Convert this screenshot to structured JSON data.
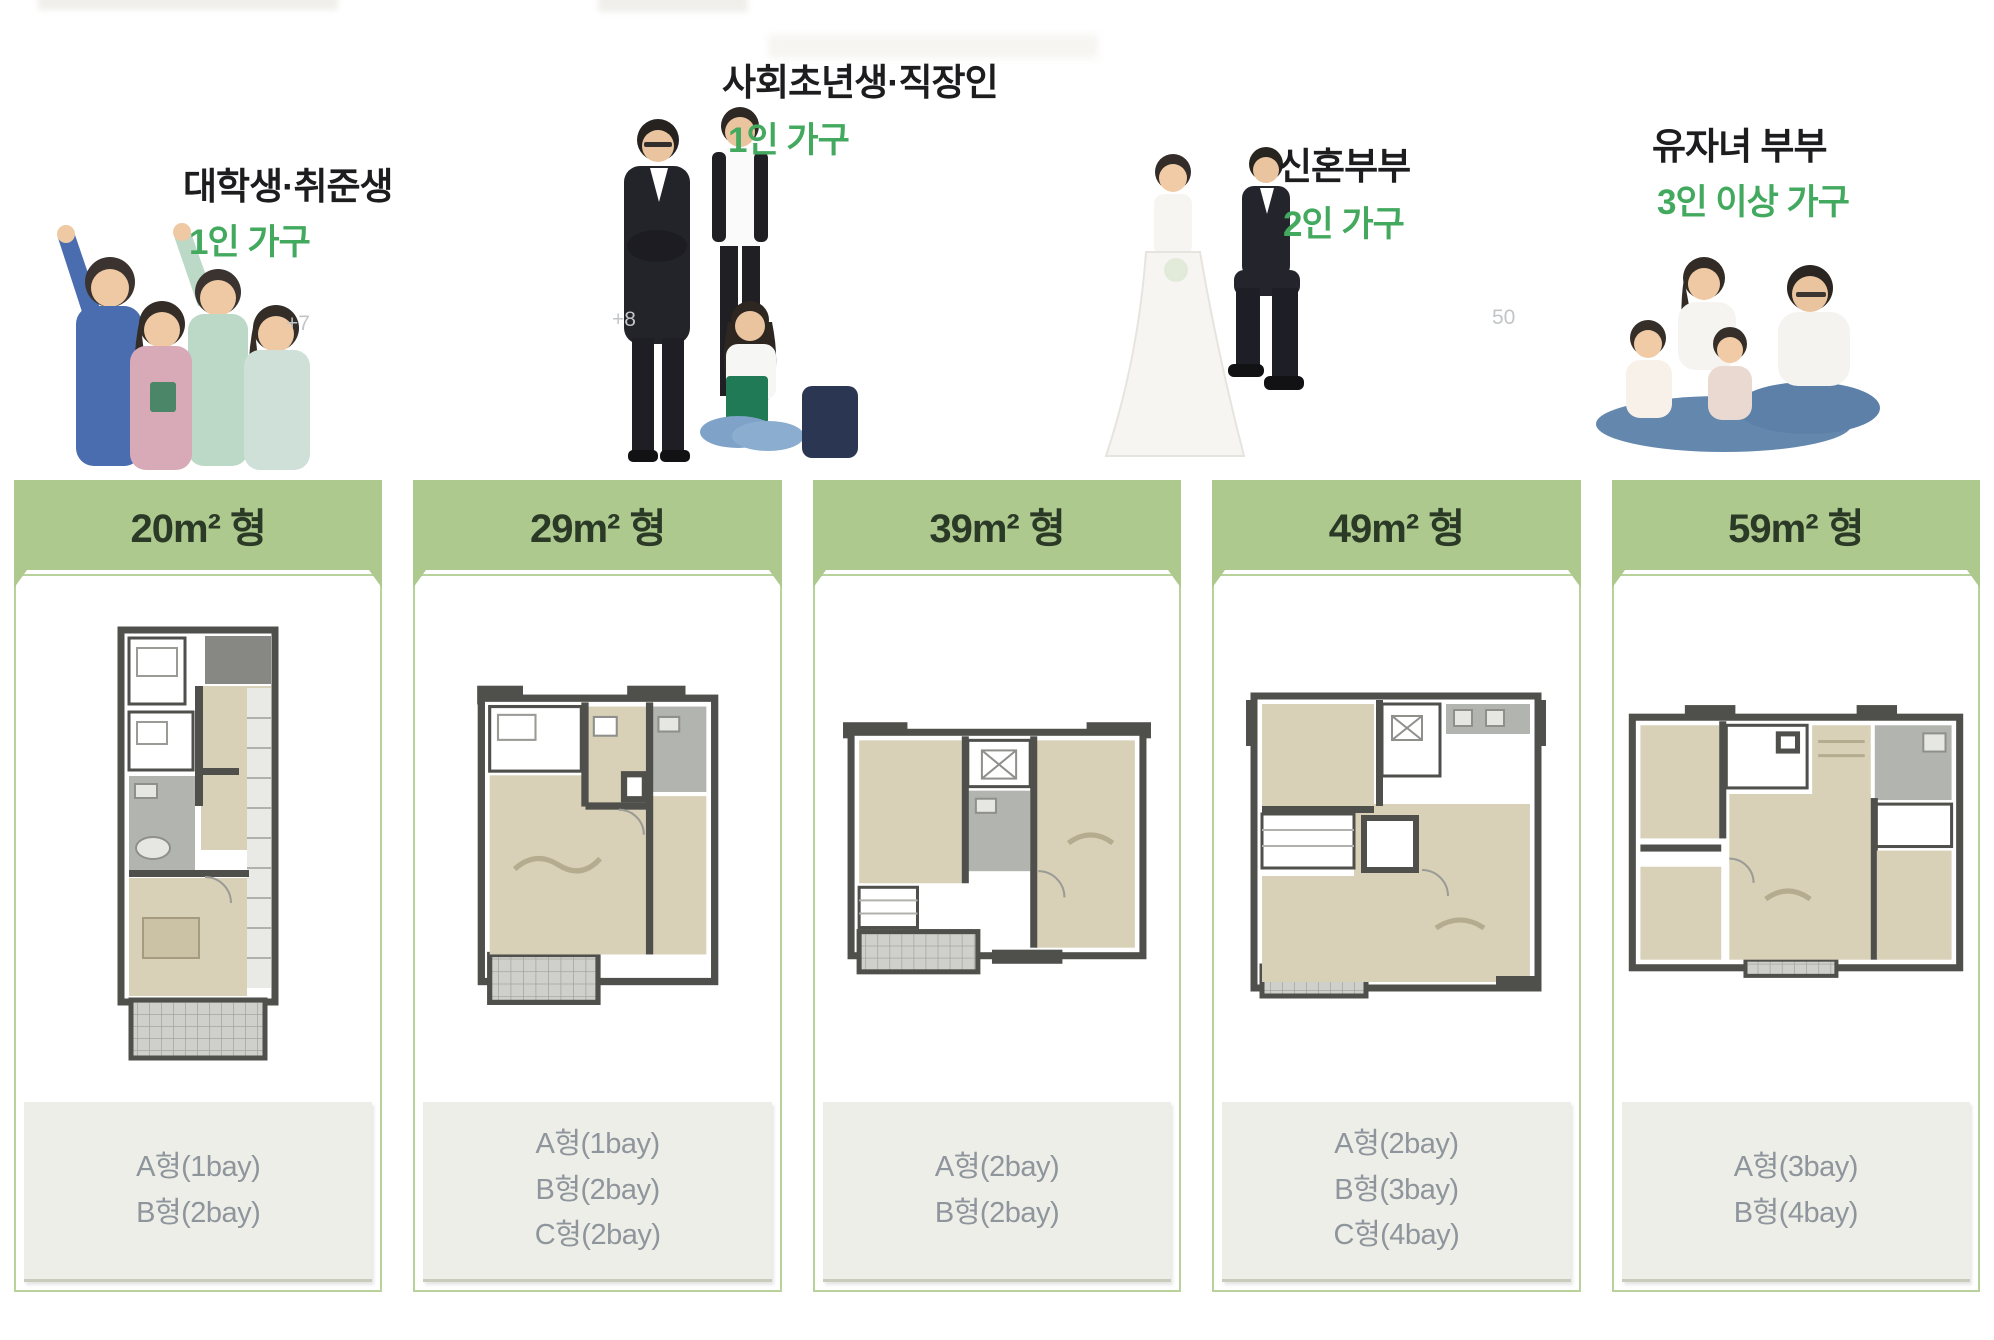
{
  "colors": {
    "accent_green": "#43a95f",
    "bar_green": "#aec98e",
    "bar_text": "#2b3a26",
    "panel_border": "#b9d29b",
    "label_bg": "#edeee7",
    "label_text": "#8f959c"
  },
  "personas": [
    {
      "name": "대학생·취준생",
      "household": "1인 가구",
      "badge": "+7"
    },
    {
      "name": "사회초년생·직장인",
      "household": "1인 가구",
      "badge": "+8"
    },
    {
      "name": "신혼부부",
      "household": "2인 가구",
      "badge": ""
    },
    {
      "name": "유자녀 부부",
      "household": "3인 이상 가구",
      "badge": "50"
    }
  ],
  "units": [
    {
      "size_label": "20m² 형",
      "types": [
        "A형(1bay)",
        "B형(2bay)"
      ]
    },
    {
      "size_label": "29m² 형",
      "types": [
        "A형(1bay)",
        "B형(2bay)",
        "C형(2bay)"
      ]
    },
    {
      "size_label": "39m² 형",
      "types": [
        "A형(2bay)",
        "B형(2bay)"
      ]
    },
    {
      "size_label": "49m² 형",
      "types": [
        "A형(2bay)",
        "B형(3bay)",
        "C형(4bay)"
      ]
    },
    {
      "size_label": "59m² 형",
      "types": [
        "A형(3bay)",
        "B형(4bay)"
      ]
    }
  ]
}
